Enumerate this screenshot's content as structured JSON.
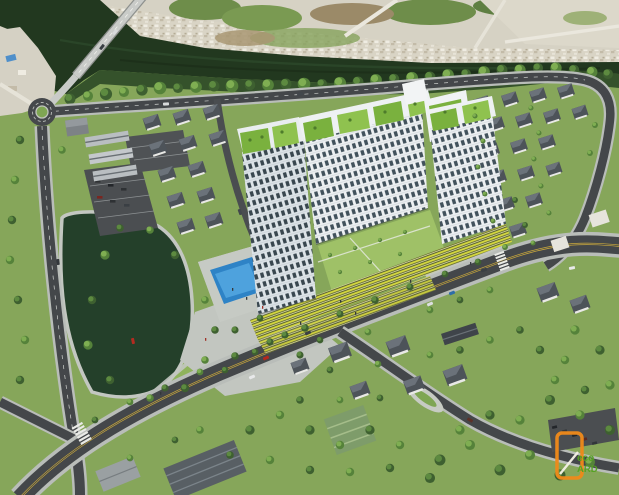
{
  "meta": {
    "type": "aerial-architectural-render",
    "subject": "Bird's-eye 3D rendering of a U-shaped high-rise apartment complex with rooftop gardens and a yellow-striped podium, set beside a dark river with a bridge, a landscaped lake park, villa neighborhoods, and a tree-lined boulevard"
  },
  "watermark": {
    "word_top": "eco",
    "word_bottom": "ARD"
  },
  "palette": {
    "river": "#22381f",
    "pond": "#24402a",
    "pool_blue": "#2e83c6",
    "pool_light": "#4ea2dd",
    "facade_white": "#eef1f3",
    "roof_green": "#7ab13e",
    "podium_yellow": "#d6d93f",
    "courtyard_lawn": "#9fc167",
    "road_asphalt": "#44474a",
    "sidewalk": "#bbbfb9",
    "lane_yellow": "#c9a83d",
    "tree_dark": "#3e6030",
    "tree_light": "#6f9b4a",
    "far_shore": "#d6d2c4",
    "villa_roof": "#4d5359",
    "logo_orange": "#ef8a1a",
    "logo_green": "#55a221"
  }
}
